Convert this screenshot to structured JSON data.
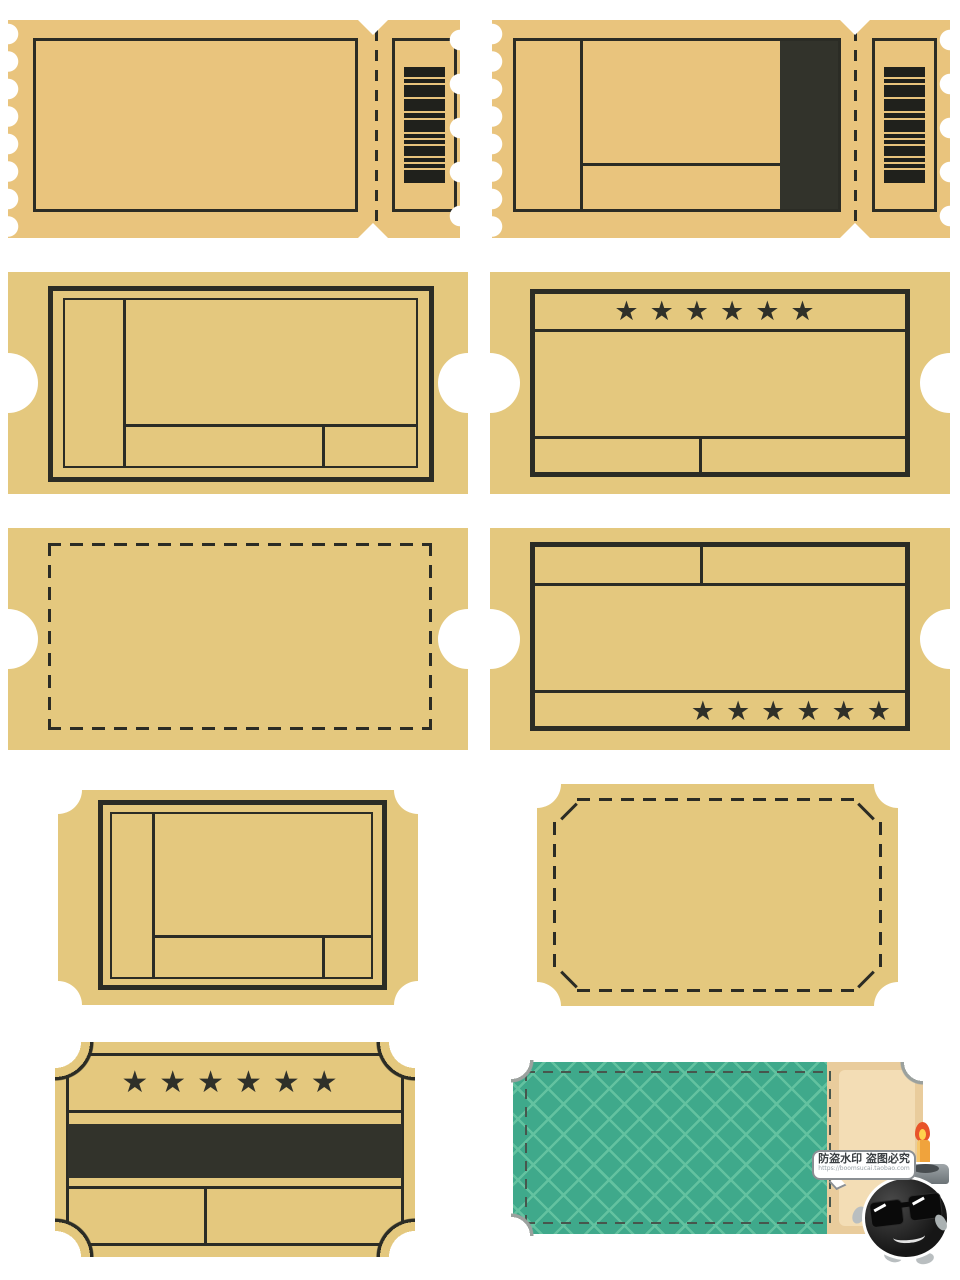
{
  "page": {
    "title": "Blank vintage ticket templates sheet",
    "background": "#FFFFFF"
  },
  "colors": {
    "ticket_tan_row1": "#E9C47D",
    "ticket_tan": "#E4C87E",
    "ink_outline": "#2B2C25",
    "dark_fill_band": "#32332B",
    "barcode_bar": "#20211C",
    "teal_body": "#3FA98B",
    "teal_lattice_line": "#63C2A0",
    "stub_tan": "#E9CC9C",
    "stub_panel": "#F3DDB5",
    "scoop_shadow": "#9BA19E"
  },
  "stars": {
    "glyph": "★",
    "count": 6,
    "row": "★★★★★★"
  },
  "barcode": {
    "orientation": "horizontal-bars",
    "bars": [
      10,
      4,
      12,
      12,
      5,
      12,
      4,
      4,
      10,
      4,
      4,
      13
    ]
  },
  "tickets": [
    {
      "id": "ticket-1",
      "position": "row1-left",
      "elements": [
        "scalloped-edges",
        "blank-frame",
        "v-notch-perforation",
        "dashed-perforation-line",
        "barcode-stub"
      ]
    },
    {
      "id": "ticket-2",
      "position": "row1-right",
      "elements": [
        "scalloped-edges",
        "field-frame-left-column",
        "horizontal-divider",
        "dark-filled-band",
        "dashed-perforation-line",
        "barcode-stub"
      ]
    },
    {
      "id": "ticket-3",
      "position": "row2-left",
      "elements": [
        "side-half-circle-notches",
        "double-frame",
        "left-column",
        "bottom-strip-two-cells"
      ]
    },
    {
      "id": "ticket-4",
      "position": "row2-right",
      "elements": [
        "side-half-circle-notches",
        "star-row-top",
        "main-field",
        "bottom-strip-two-cells"
      ],
      "stars": 6
    },
    {
      "id": "ticket-5",
      "position": "row3-left",
      "elements": [
        "side-half-circle-notches",
        "dashed-blank-frame"
      ]
    },
    {
      "id": "ticket-6",
      "position": "row3-right",
      "elements": [
        "side-half-circle-notches",
        "top-strip-two-cells",
        "main-field",
        "star-row-bottom"
      ],
      "stars": 6
    },
    {
      "id": "ticket-7",
      "position": "row4-left",
      "elements": [
        "bracket-corners",
        "double-frame",
        "left-column",
        "bottom-strip-two-cells"
      ]
    },
    {
      "id": "ticket-8",
      "position": "row4-right",
      "elements": [
        "bracket-corners",
        "dashed-frame-chamfered-corners"
      ]
    },
    {
      "id": "ticket-9",
      "position": "row5-left",
      "elements": [
        "bracket-corners",
        "inner-outline",
        "star-row-top",
        "dark-stripe",
        "bottom-strip-two-cells"
      ],
      "stars": 6
    },
    {
      "id": "ticket-10",
      "position": "row5-right",
      "elements": [
        "teal-lattice-body",
        "dashed-outline",
        "dashed-stub-separator",
        "tan-stub-panel",
        "bracket-corners"
      ]
    }
  ],
  "watermark": {
    "bubble_line1": "防盗水印 盗图必究",
    "bubble_line2": "https://boomsucai.taobao.com",
    "mascot": "bomb-cartoon-sunglasses-candle"
  }
}
